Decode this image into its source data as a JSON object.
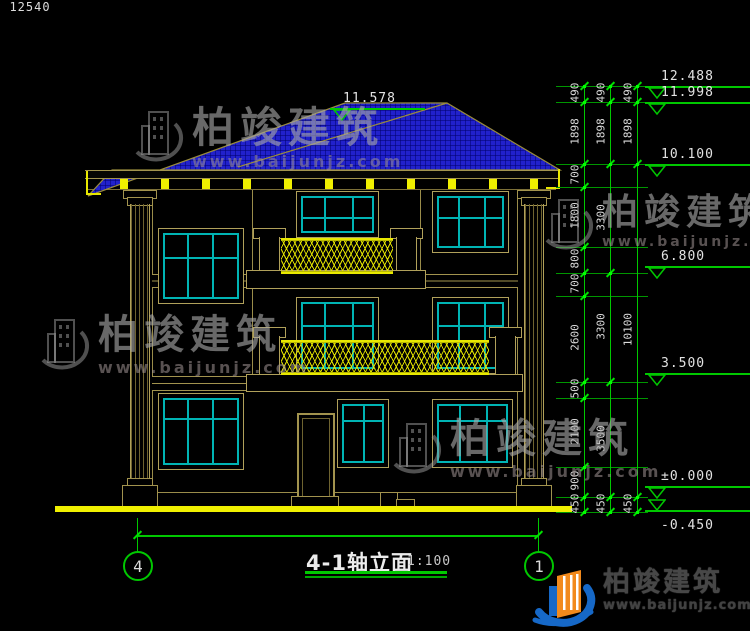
{
  "title_block": {
    "title": "4-1轴立面",
    "scale": "1:100"
  },
  "watermark": {
    "brand": "柏竣建筑",
    "url": "www.baijunjz.com"
  },
  "footer": {
    "brand": "柏竣建筑",
    "url": "www.baijunjz.com"
  },
  "overall_dim": {
    "label": "12540",
    "y": 535,
    "x1": 137,
    "x2": 538
  },
  "axes": [
    {
      "label": "4",
      "cx": 137,
      "cy": 565
    },
    {
      "label": "1",
      "cx": 538,
      "cy": 565
    }
  ],
  "elevation_markers": [
    {
      "label": "11.578",
      "y": 108,
      "x1": 330,
      "x2": 425,
      "tri_x": 333,
      "lx": 343
    },
    {
      "label": "12.488",
      "y": 86
    },
    {
      "label": "11.998",
      "y": 102
    },
    {
      "label": "10.100",
      "y": 164
    },
    {
      "label": "6.800",
      "y": 266
    },
    {
      "label": "3.500",
      "y": 373
    },
    {
      "label": "±0.000",
      "y": 486
    },
    {
      "label": "-0.450",
      "y": 510,
      "below": true,
      "tri_above": true
    }
  ],
  "dim_columns": [
    {
      "x": 584,
      "boundaries": [
        86,
        102,
        164,
        187,
        247,
        273,
        296,
        382,
        398,
        467,
        497,
        512
      ],
      "labels": [
        "490",
        "1898",
        "700",
        "1800",
        "800",
        "700",
        "2600",
        "500",
        "2100",
        "900",
        "450"
      ]
    },
    {
      "x": 610,
      "boundaries": [
        86,
        102,
        164,
        273,
        382,
        497,
        512
      ],
      "labels": [
        "490",
        "1898",
        "3300",
        "3300",
        "3500",
        "450"
      ]
    },
    {
      "x": 637,
      "boundaries": [
        86,
        102,
        164,
        497,
        512
      ],
      "labels": [
        "490",
        "1898",
        "10100",
        "450"
      ]
    }
  ],
  "extension_lines": [
    86,
    102,
    164,
    187,
    247,
    273,
    296,
    382,
    398,
    467,
    497,
    512
  ],
  "facade": {
    "windows": [
      {
        "id": "stair-upper",
        "x": 158,
        "y": 228,
        "w": 86,
        "h": 76,
        "v": [
          187,
          212
        ],
        "hm": [
          257
        ]
      },
      {
        "id": "stair-lower",
        "x": 158,
        "y": 393,
        "w": 86,
        "h": 77,
        "v": [
          187,
          212
        ],
        "hm": [
          418
        ]
      },
      {
        "id": "floor3-balcony",
        "x": 296,
        "y": 191,
        "w": 83,
        "h": 47,
        "v": [
          324,
          352
        ],
        "hm": [
          217
        ]
      },
      {
        "id": "floor3-right",
        "x": 432,
        "y": 191,
        "w": 77,
        "h": 62,
        "v": [
          458,
          484
        ],
        "hm": [
          217
        ]
      },
      {
        "id": "floor2-balcony",
        "x": 296,
        "y": 297,
        "w": 83,
        "h": 77,
        "v": [
          324,
          352
        ],
        "hm": [
          325
        ]
      },
      {
        "id": "floor2-right",
        "x": 432,
        "y": 297,
        "w": 77,
        "h": 77,
        "v": [
          458,
          484
        ],
        "hm": [
          325
        ]
      },
      {
        "id": "floor1-center",
        "x": 337,
        "y": 399,
        "w": 52,
        "h": 69,
        "v": [
          363
        ],
        "hm": [
          420
        ]
      },
      {
        "id": "floor1-right",
        "x": 432,
        "y": 399,
        "w": 81,
        "h": 69,
        "v": [
          459,
          486
        ],
        "hm": [
          420
        ]
      }
    ],
    "eave_brackets": {
      "y": 179,
      "w": 8,
      "h": 10,
      "xs": [
        120,
        161,
        202,
        243,
        284,
        325,
        366,
        407,
        448,
        489,
        530
      ]
    }
  },
  "watermarks": [
    {
      "x": 130,
      "y": 106,
      "fs": 42,
      "us": 16
    },
    {
      "x": 540,
      "y": 194,
      "fs": 36,
      "us": 14
    },
    {
      "x": 36,
      "y": 314,
      "fs": 40,
      "us": 16
    },
    {
      "x": 388,
      "y": 418,
      "fs": 40,
      "us": 16
    }
  ],
  "colors": {
    "structure_line": "#a2934e",
    "glass": "#00b4b4",
    "accent_yellow": "#f0f000",
    "dimension_green": "#00c800",
    "roof_blue": "#2121cc",
    "text": "#e2e2e2"
  }
}
